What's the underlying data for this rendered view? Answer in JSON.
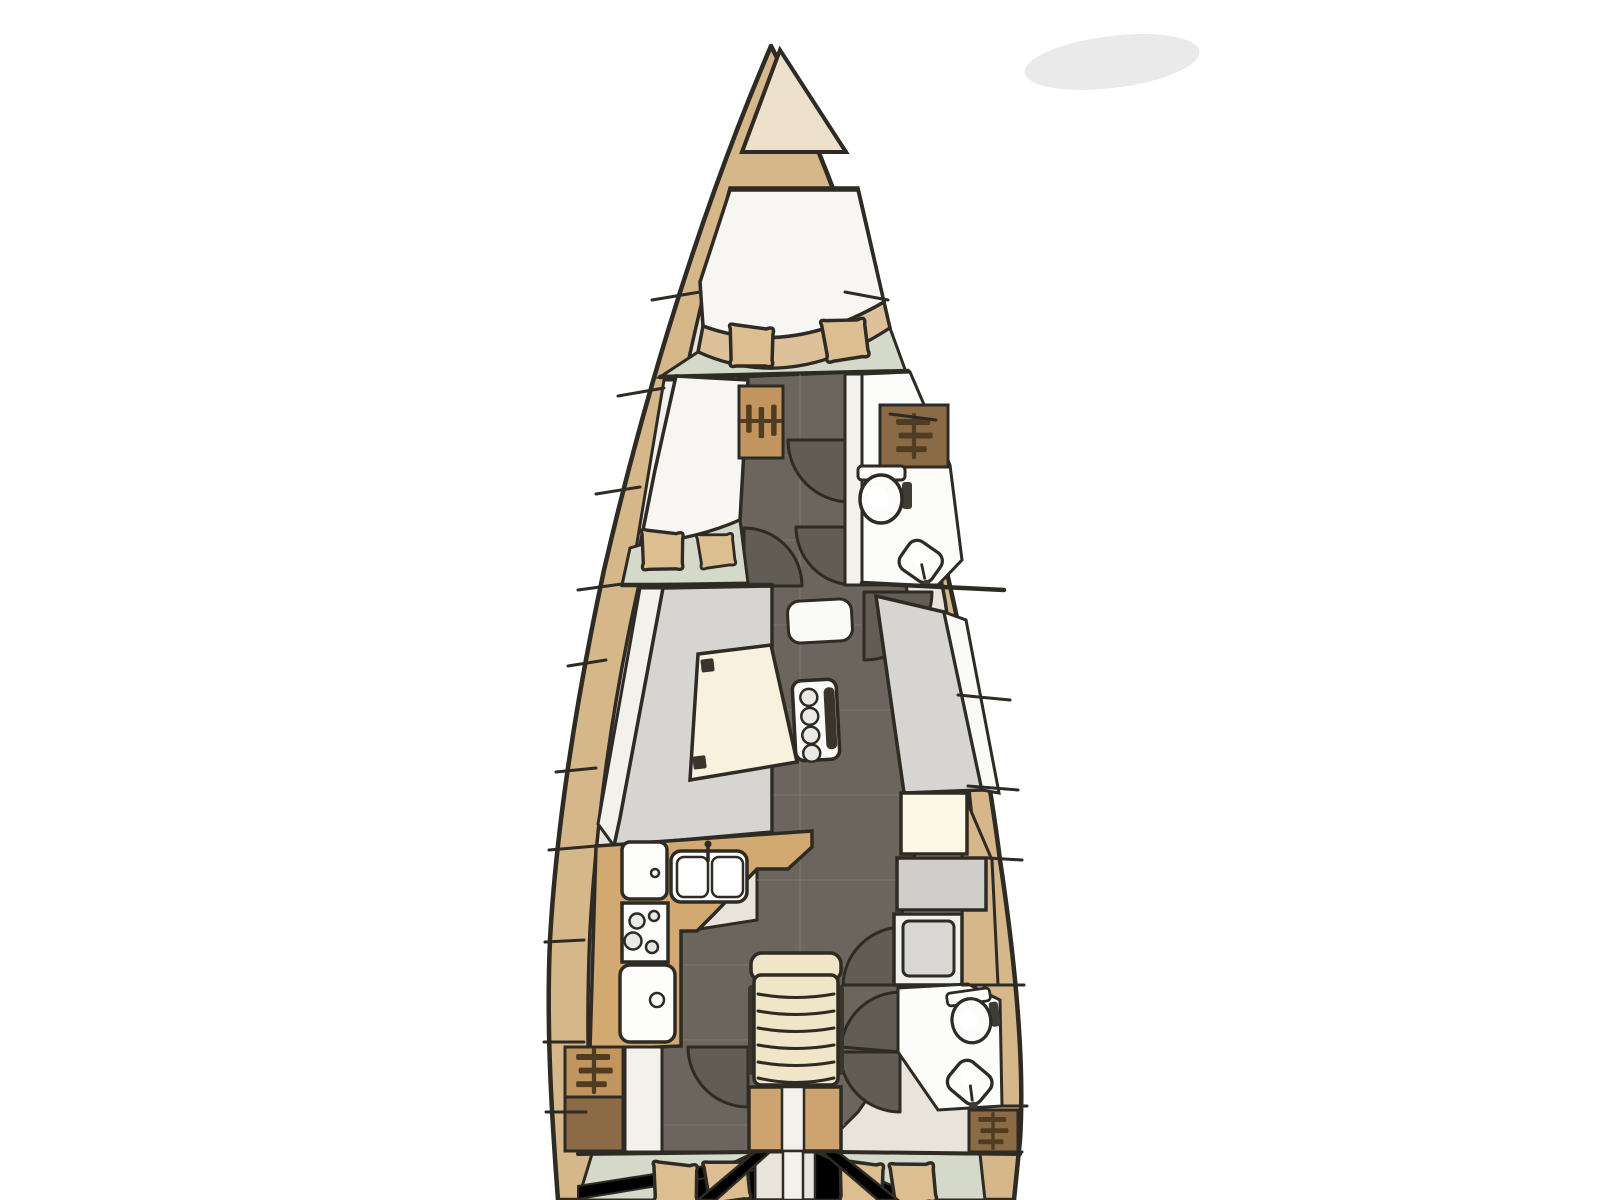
{
  "meta": {
    "title": "Sailboat interior floor plan — top-down deck layout drawing",
    "type": "yacht-floorplan-diagram",
    "view": "top-down, bow at top, stern cropped at bottom",
    "visible_text": "none"
  },
  "colors": {
    "background": "#ffffff",
    "line": "#2e2a24",
    "hull": "#d6b78a",
    "bowLocker": "#ede1cb",
    "interiorBase": "#e8e4db",
    "berth": "#f7f6f2",
    "footBand": "#dcc19b",
    "sage": "#d5d9ca",
    "corridor": "#6b655d",
    "corridorSeam": "#7e786f",
    "doorLeaf": "#615c54",
    "sideDeck": "#f2f1ec",
    "settee": "#d6d5d1",
    "backrest": "#fafaf7",
    "table": "#f8f1de",
    "tableBracket": "#3a342c",
    "counter": "#d2a970",
    "applianceWhite": "#fdfdfc",
    "applianceShade": "#e9e9e6",
    "steps": "#f0e5c7",
    "stepRail": "#3b352b",
    "engine": "#cda46f",
    "navDesk": "#fdf7e5",
    "navSeat": "#cfceca",
    "cabinetFill": "#f1f1ee",
    "cabinetInner": "#d8d7d3",
    "wardrobeTan": "#c2955f",
    "wardrobeBrown": "#8b6b46",
    "hangerIcon": "#503c20",
    "fixture": "#fcfcfb",
    "pillow": "#ddbe90",
    "shadow": "#dcdcdc"
  },
  "rooms": [
    {
      "id": "anchor-locker",
      "label": "Anchor locker (bow)"
    },
    {
      "id": "forward-cabin",
      "label": "Forward owner cabin with V-berth and two pillows"
    },
    {
      "id": "port-guest-cabin",
      "label": "Port guest cabin with angled berth and two pillows"
    },
    {
      "id": "forward-head",
      "label": "Forward head with toilet and washbasin"
    },
    {
      "id": "corridor",
      "label": "Central corridor with cabin doors"
    },
    {
      "id": "salon",
      "label": "Salon with L-settee, table and bottle holder"
    },
    {
      "id": "galley",
      "label": "Port galley with fridge, double sink, stove and icebox"
    },
    {
      "id": "nav-station",
      "label": "Navigation station with chart table and seat"
    },
    {
      "id": "companionway",
      "label": "Companionway steps"
    },
    {
      "id": "engine-compartment",
      "label": "Engine box under the steps"
    },
    {
      "id": "aft-head",
      "label": "Aft head with toilet and washbasin"
    },
    {
      "id": "port-aft-cabin",
      "label": "Port aft cabin with double berth and two pillows"
    },
    {
      "id": "starboard-aft-cabin",
      "label": "Starboard aft cabin with double berth and two pillows"
    }
  ],
  "fixtures": [
    {
      "id": "toilet-icon",
      "label": "Toilet"
    },
    {
      "id": "sink-icon",
      "label": "Washbasin"
    },
    {
      "id": "double-sink-icon",
      "label": "Galley double sink with faucet"
    },
    {
      "id": "stove-icon",
      "label": "Stove with burners"
    },
    {
      "id": "fridge-icon",
      "label": "Fridge / oven"
    },
    {
      "id": "icebox-icon",
      "label": "Icebox"
    },
    {
      "id": "hanger-icon",
      "label": "Hanging locker (wardrobe rail)"
    },
    {
      "id": "pillow",
      "label": "Pillow"
    },
    {
      "id": "door-arc",
      "label": "Door swing arc"
    },
    {
      "id": "bottle-holder",
      "label": "Table bottle holder with four cup rings"
    }
  ]
}
